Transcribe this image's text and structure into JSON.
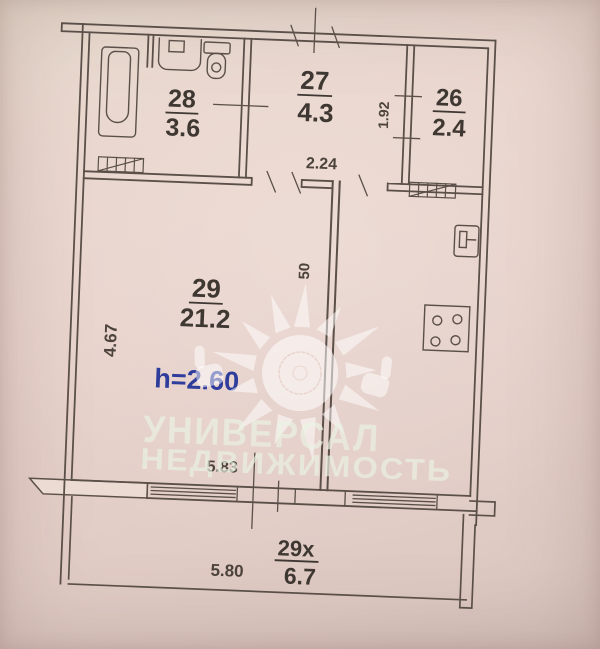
{
  "plan": {
    "title": "apartment-floor-plan",
    "rooms": [
      {
        "number": "28",
        "area": "3.6"
      },
      {
        "number": "27",
        "area": "4.3"
      },
      {
        "number": "26",
        "area": "2.4"
      },
      {
        "number": "29",
        "area": "21.2"
      },
      {
        "number": "29x",
        "area": "6.7"
      }
    ],
    "ceiling_height_label": "h=2.60",
    "dimensions": {
      "room29_left_side": "4.67",
      "hallway_width": "2.24",
      "room26_side": "1.92",
      "partition_stub": "50",
      "room29_bottom": "5.83",
      "balcony_width": "5.80"
    },
    "watermark": {
      "line1": "УНИВЕРСАЛ",
      "line2": "НЕДВИЖИМОСТЬ"
    },
    "colors": {
      "paper": "#e8d4cc",
      "ink": "#594f48",
      "label_ink": "#3e3732",
      "height_note": "#2e3c9b",
      "watermark": "#e9f3e3"
    }
  }
}
